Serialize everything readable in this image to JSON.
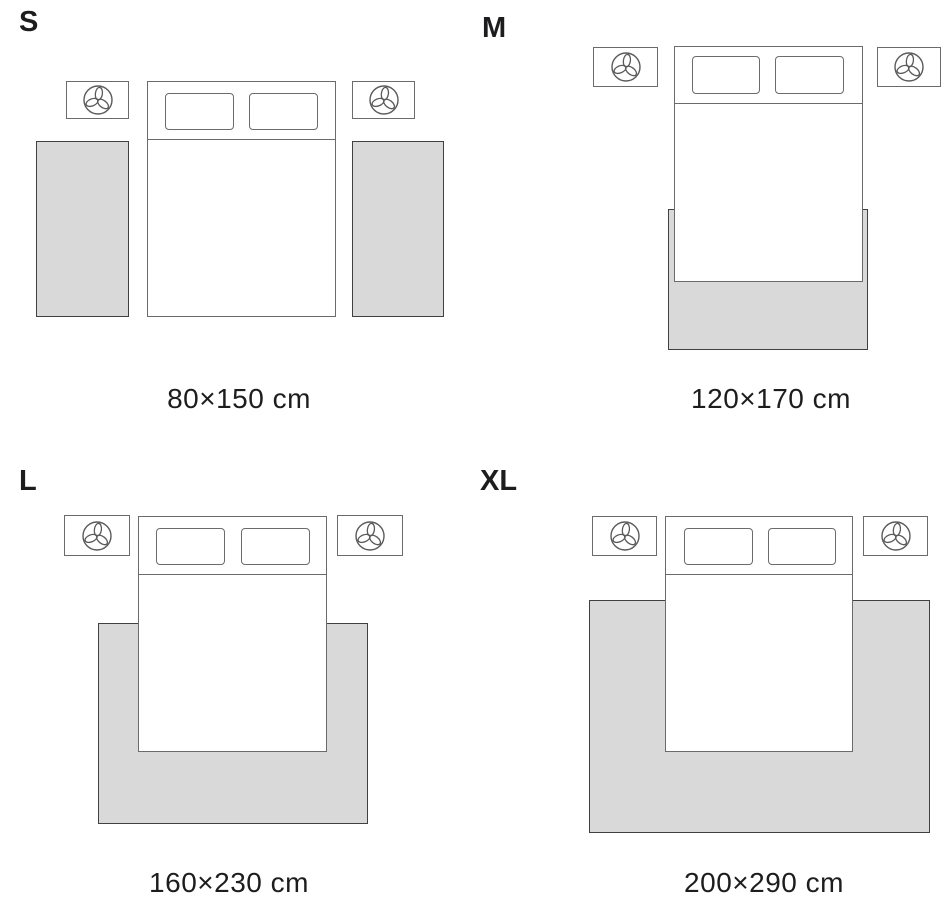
{
  "panels": [
    {
      "label": "S",
      "caption": "80×150 cm",
      "rug_placement": "two runners beside bed"
    },
    {
      "label": "M",
      "caption": "120×170 cm",
      "rug_placement": "under lower half of bed"
    },
    {
      "label": "L",
      "caption": "160×230 cm",
      "rug_placement": "under bed extending on three sides"
    },
    {
      "label": "XL",
      "caption": "200×290 cm",
      "rug_placement": "under bed spanning full nightstand width"
    }
  ],
  "colors": {
    "background": "#ffffff",
    "rug_fill": "#d9d9d9",
    "rug_border": "#414141",
    "furniture_border": "#6b6b6b",
    "text": "#1d1d1f"
  },
  "icons": {
    "nightstand_decor": "plant-icon"
  }
}
